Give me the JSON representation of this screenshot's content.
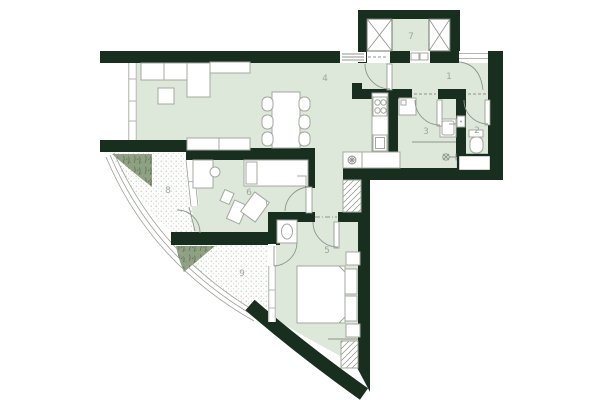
{
  "rooms": [
    {
      "label": "1"
    },
    {
      "label": "2"
    },
    {
      "label": "3"
    },
    {
      "label": "4"
    },
    {
      "label": "5"
    },
    {
      "label": "6"
    },
    {
      "label": "7"
    },
    {
      "label": "8"
    },
    {
      "label": "9"
    }
  ],
  "colors": {
    "wall": "#182f20",
    "floor": "#dde7da",
    "plant": "#8fa183",
    "plant_stroke": "#5d7452",
    "furniture_stroke": "#a3a89f",
    "door_line": "#8f958c",
    "railing": "#9aa096",
    "balcony_dots": "#a9b1a7",
    "label_text": "#9da89c",
    "background": "#ffffff"
  }
}
